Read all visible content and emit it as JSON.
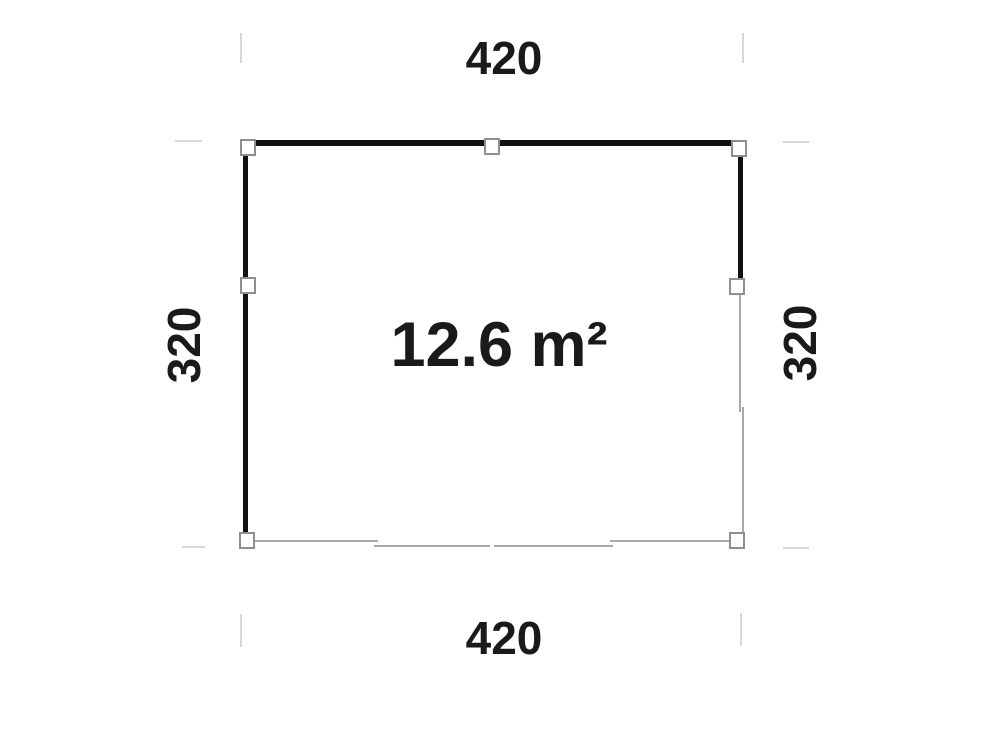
{
  "figure": {
    "type": "floor-plan",
    "area_label": "12.6 m²",
    "dim_top": "420",
    "dim_bottom": "420",
    "dim_left": "320",
    "dim_right": "320"
  },
  "colors": {
    "background": "#ffffff",
    "wall": "#111111",
    "open_edge": "#a8a8a8",
    "extension_line": "#d8d8d8",
    "post_fill": "#ffffff",
    "post_border": "#8f8f8f",
    "text": "#1a1a1a"
  },
  "posts": [
    "top-left",
    "top-center",
    "top-right",
    "left-middle",
    "right-middle",
    "bottom-left",
    "bottom-right"
  ]
}
